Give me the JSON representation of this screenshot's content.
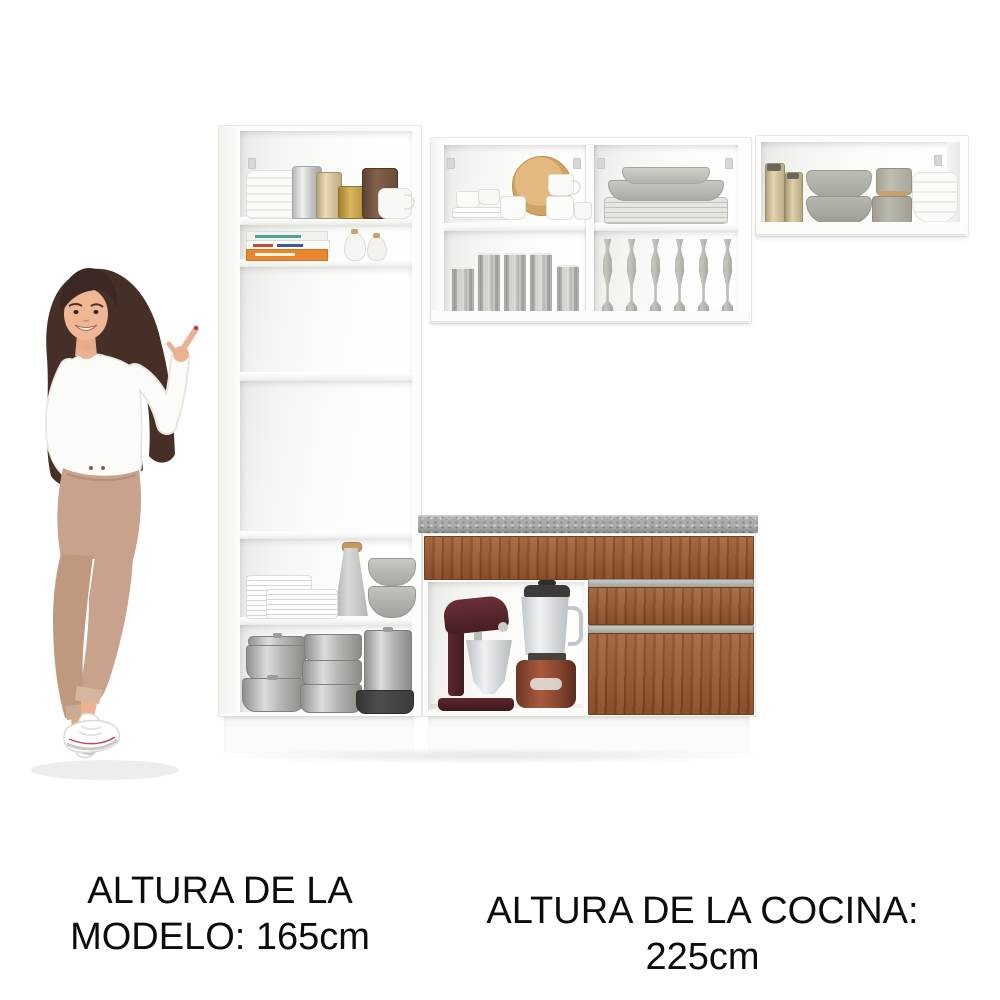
{
  "captions": {
    "model_height_line1": "ALTURA DE LA",
    "model_height_line2": "MODELO: 165cm",
    "kitchen_height": "ALTURA DE LA COCINA: 225cm"
  },
  "palette": {
    "background": "#ffffff",
    "cabinet_white": "#fdfdfb",
    "cabinet_edge": "#e6e6e3",
    "wood_drawer": "#95562f",
    "countertop_gray": "#a9ada7",
    "handle_gray": "#aeb0ab",
    "text_black": "#0c0c0c",
    "model_hair": "#452f27",
    "model_top": "#fbfbf8",
    "model_trousers": "#c8a28c"
  },
  "scene": {
    "model": "woman pointing at the kitchen set",
    "kitchen_sections": [
      {
        "name": "tall-pantry-cabinet",
        "shelves": [
          "white jars, silver, gold and brown canisters, teapot",
          "cookbooks and two shakers",
          "open shelf",
          "open oven niche",
          "white plates, grater, gray bowls",
          "aluminum pots and black pan"
        ]
      },
      {
        "name": "upper-wall-cabinet-center",
        "cells": [
          "white cups, wooden plate, mugs",
          "gray plate and platter stack",
          "gray tumblers",
          "gray stemmed glasses"
        ]
      },
      {
        "name": "upper-wall-cabinet-right",
        "cells": [
          "gold canisters, gray bowls, lidded jars, white bowls"
        ]
      },
      {
        "name": "base-counter-cabinet",
        "features": [
          "speckled gray countertop",
          "full-width wood drawer",
          "open niche with stand mixer and blender",
          "wood drawer",
          "wood door"
        ]
      }
    ]
  }
}
